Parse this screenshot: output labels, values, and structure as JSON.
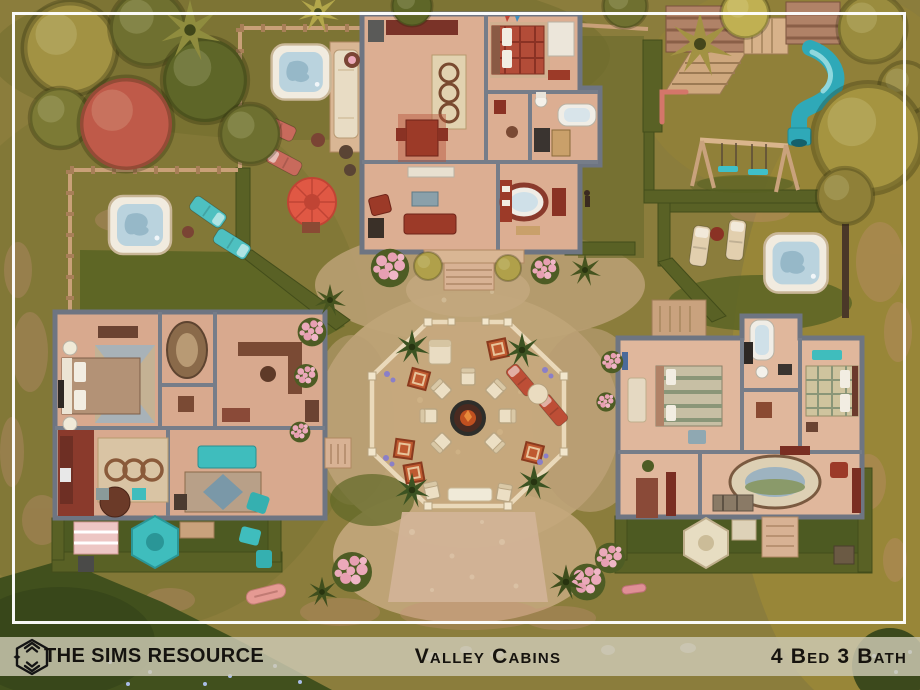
{
  "footer": {
    "brand": "THE SIMS RESOURCE",
    "title": "Valley Cabins",
    "stats": "4 Bed 3 Bath"
  },
  "scene": {
    "description": "Top-down aerial floor-plan view of a Sims 4 lot: three log cabins arranged around a central octagonal courtyard with a fire pit and chairs, plus hot tubs, lounge chairs, patio umbrellas, a treehouse fort with teal tube slide, a swing set, hedges, wooden fences, rose bushes and autumn trees.",
    "objects": [
      "top cabin floor plan",
      "left cabin floor plan",
      "right cabin floor plan",
      "octagonal fenced courtyard",
      "fire pit with chairs",
      "hot tub (top yard)",
      "hot tub (left yard)",
      "hot tub (right yard)",
      "red patio umbrella",
      "teal patio umbrella",
      "cream patio umbrella",
      "treehouse fort",
      "teal tube slide",
      "swing set",
      "monkey bar",
      "lounge chairs",
      "picnic table",
      "kayaks",
      "rose bushes",
      "hedges",
      "wooden fences",
      "gravel path",
      "trees"
    ],
    "colors": {
      "ground_olive": "#8b7d3c",
      "ground_dark": "#55611f",
      "dirt_tan": "#bfa478",
      "path_pink": "#d2b397",
      "cabin_wall": "#6e7582",
      "cabin_floor": "#dcae92",
      "accent_red": "#9c3a28",
      "teal": "#3fc0c9",
      "cream": "#ecdfc4",
      "hedge_green": "#596125",
      "water_blue": "#bad3de",
      "flower_pink": "#eba9ba",
      "red_tree": "#bf5a49",
      "band_bg": "#cec9b4",
      "text": "#15130f",
      "frame": "#ffffff"
    }
  }
}
